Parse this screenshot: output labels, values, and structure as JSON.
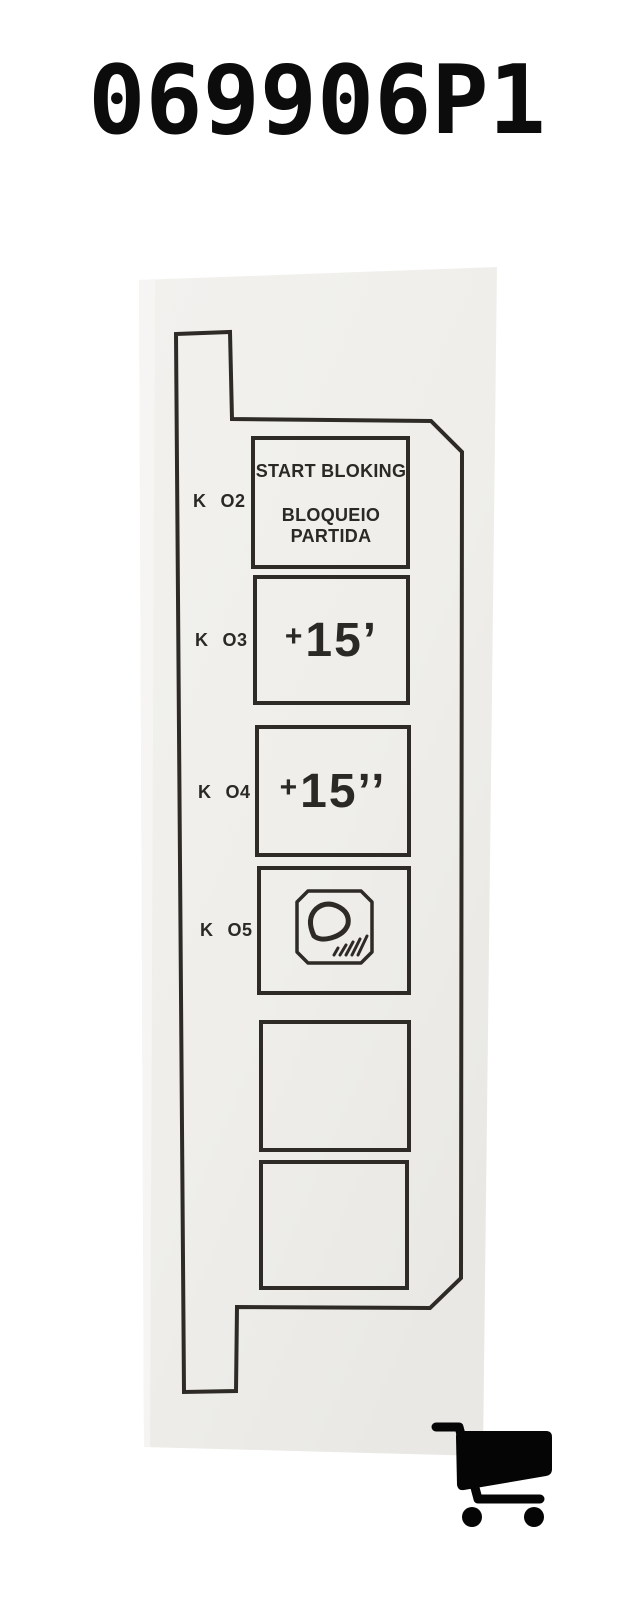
{
  "product": {
    "code": "069906P1"
  },
  "label": {
    "rows": [
      {
        "connector": "K",
        "terminal": "O2",
        "lines": [
          "START BLOKING",
          "BLOQUEIO",
          "PARTIDA"
        ]
      },
      {
        "connector": "K",
        "terminal": "O3",
        "sign": "+",
        "value": "15’"
      },
      {
        "connector": "K",
        "terminal": "O4",
        "sign": "+",
        "value": "15’’"
      },
      {
        "connector": "K",
        "terminal": "O5",
        "icon": "headlight-beam-icon"
      },
      {
        "empty": true
      },
      {
        "empty": true
      }
    ]
  },
  "actions": {
    "cart_icon": "shopping-cart-icon"
  },
  "colors": {
    "page_bg": "#ffffff",
    "paper": "#efeeea",
    "ink": "#2e2b27",
    "title_text": "#0c0c0c",
    "cart": "#050505"
  }
}
